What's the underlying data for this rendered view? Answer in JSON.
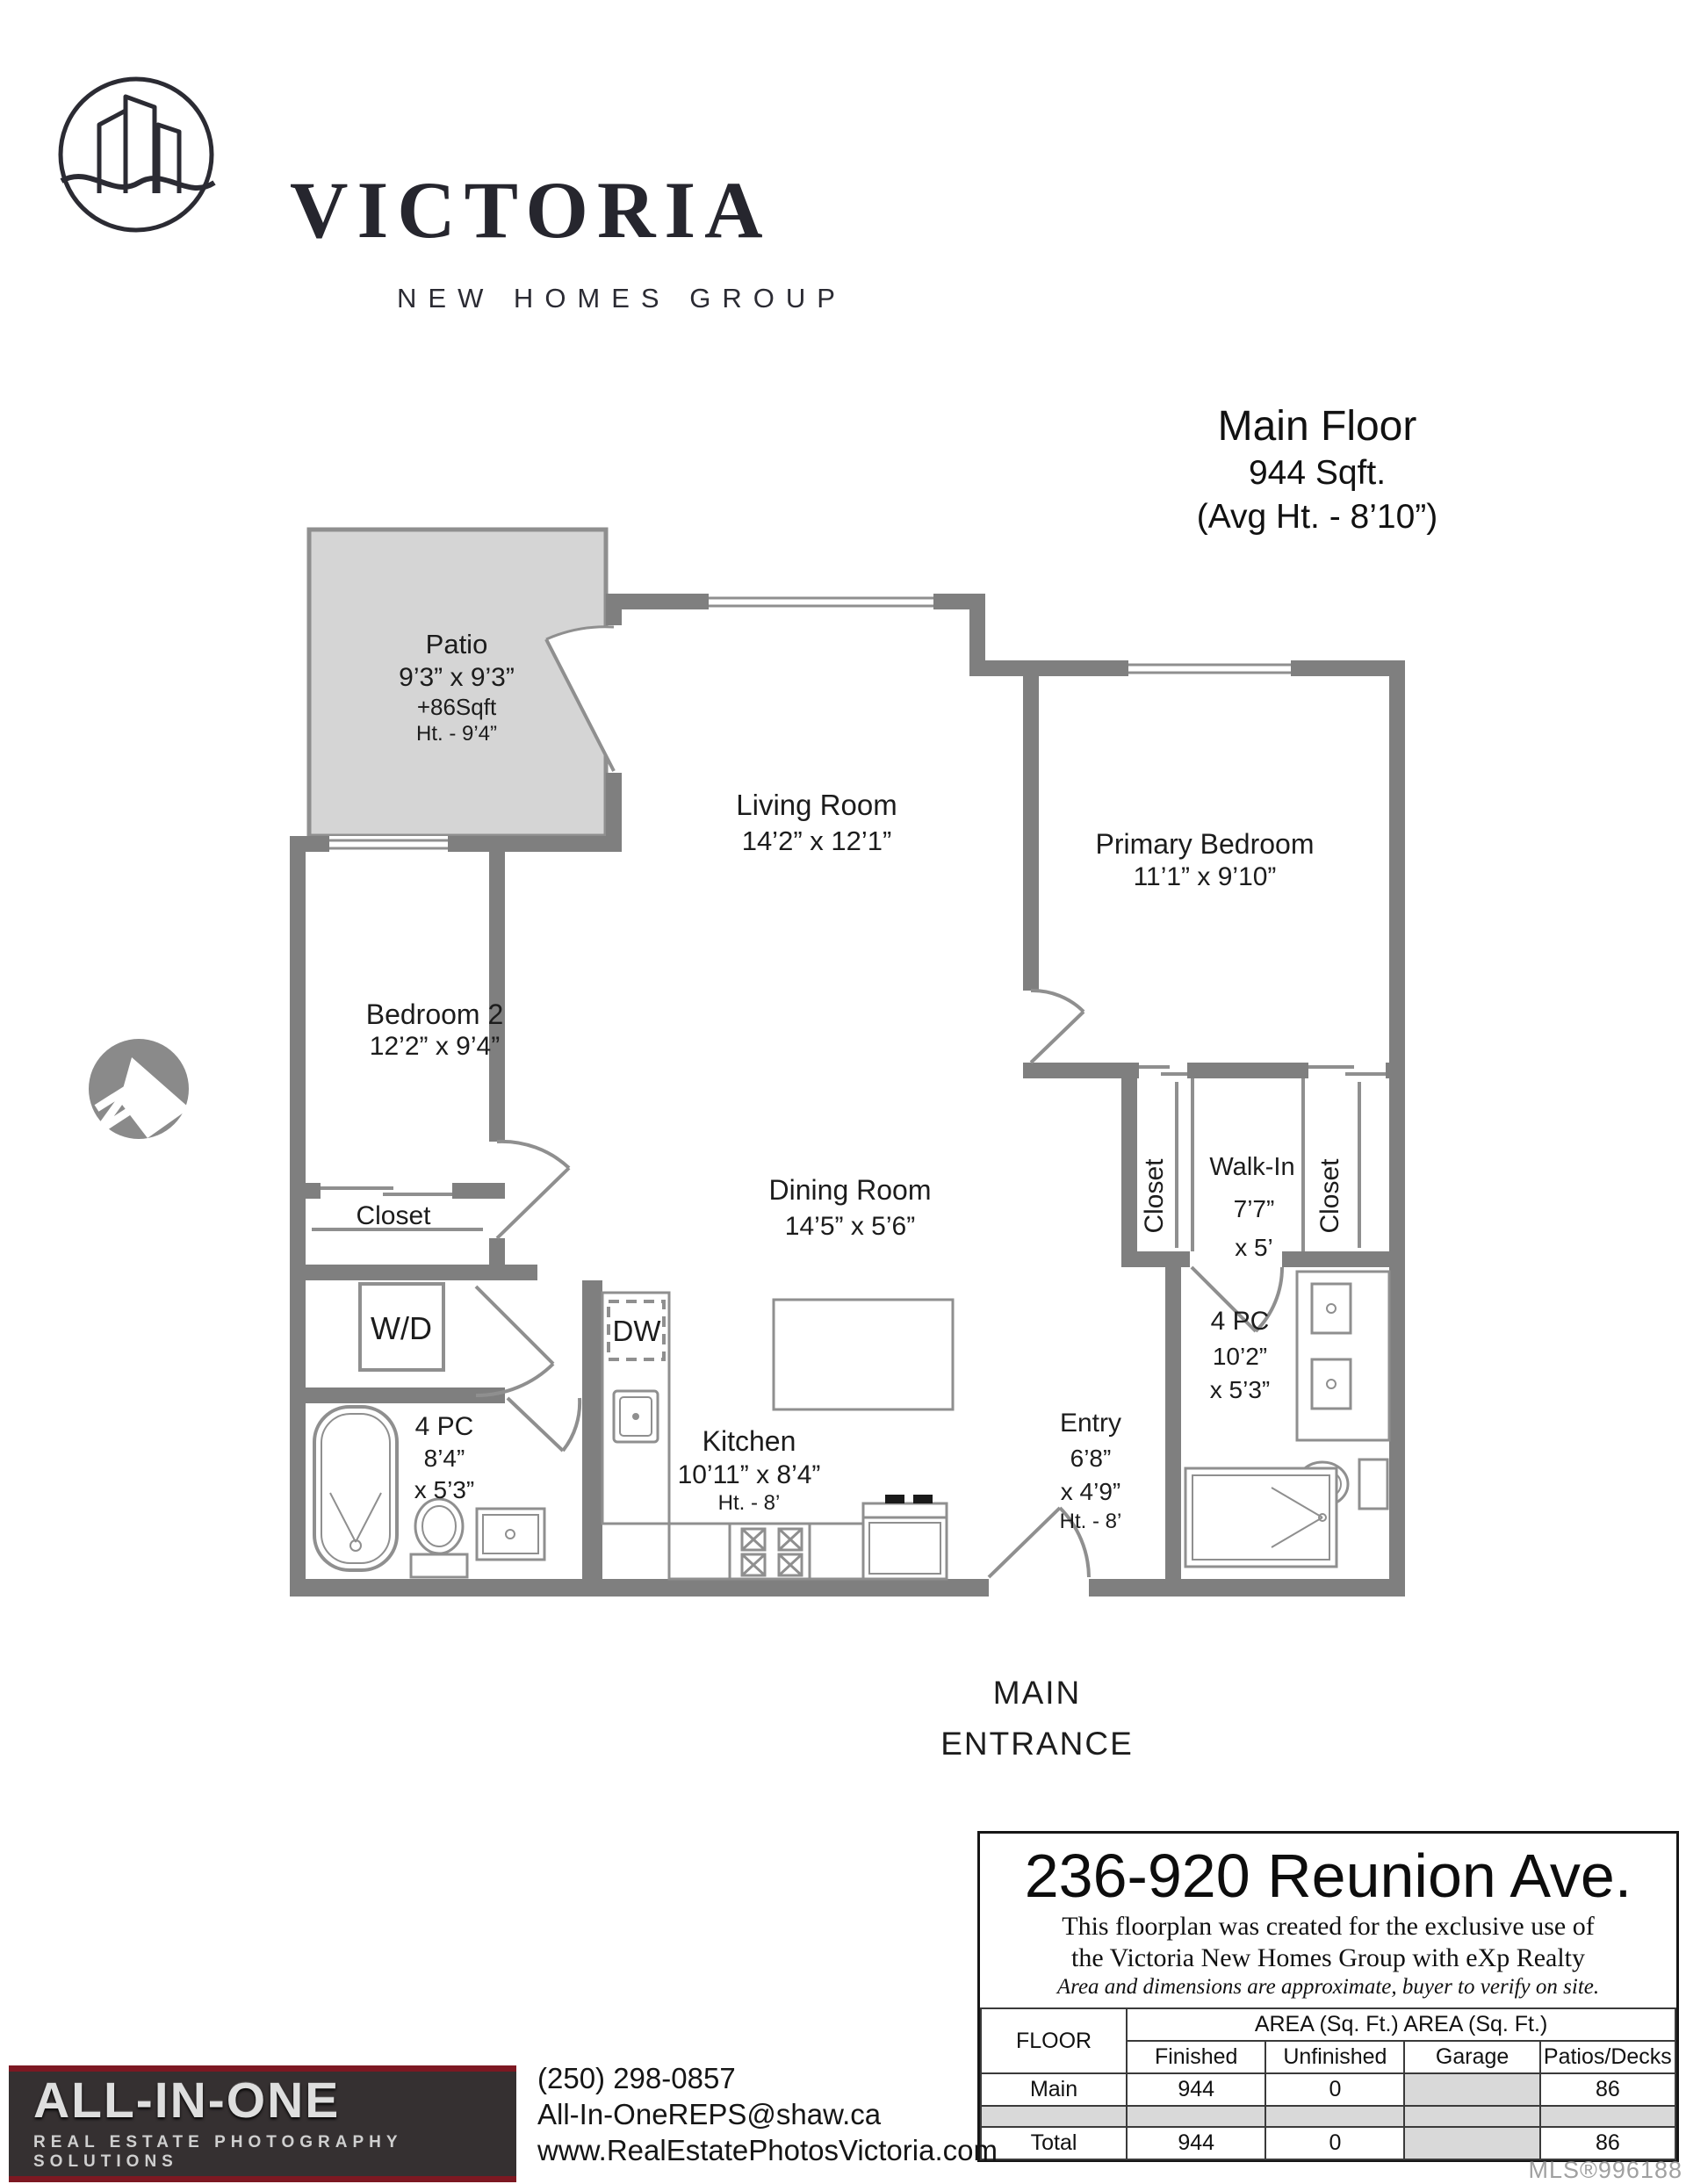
{
  "branding": {
    "logo_title": "VICTORIA",
    "logo_subtitle": "NEW HOMES GROUP"
  },
  "floor_header": {
    "title": "Main Floor",
    "area": "944 Sqft.",
    "avg_height": "(Avg Ht. - 8’10”)"
  },
  "rooms": {
    "patio": {
      "name": "Patio",
      "dims": "9’3” x 9’3”",
      "area": "+86Sqft",
      "height": "Ht. - 9’4”"
    },
    "living": {
      "name": "Living Room",
      "dims": "14’2” x 12’1”"
    },
    "primary": {
      "name": "Primary Bedroom",
      "dims": "11’1” x 9’10”"
    },
    "bedroom2": {
      "name": "Bedroom 2",
      "dims": "12’2” x 9’4”"
    },
    "dining": {
      "name": "Dining Room",
      "dims": "14’5” x 5’6”"
    },
    "walkin": {
      "name": "Walk-In",
      "dim1": "7’7”",
      "dim2": "x 5’"
    },
    "closet_left": {
      "name": "Closet"
    },
    "closet_right": {
      "name": "Closet"
    },
    "closet_bed2": {
      "name": "Closet"
    },
    "wd": {
      "label": "W/D"
    },
    "dw": {
      "label": "DW"
    },
    "bath_left": {
      "name": "4 PC",
      "dim1": "8’4”",
      "dim2": "x 5’3”"
    },
    "bath_right": {
      "name": "4 PC",
      "dim1": "10’2”",
      "dim2": "x 5’3”"
    },
    "kitchen": {
      "name": "Kitchen",
      "dims": "10’11” x 8’4”",
      "height": "Ht. - 8’"
    },
    "entry": {
      "name": "Entry",
      "dim1": "6’8”",
      "dim2": "x 4’9”",
      "height": "Ht. - 8’"
    }
  },
  "main_entrance": {
    "line1": "MAIN",
    "line2": "ENTRANCE"
  },
  "info_box": {
    "address": "236-920 Reunion Ave.",
    "disclaimer1": "This floorplan was created for the exclusive use of",
    "disclaimer2": "the Victoria New Homes Group with eXp Realty",
    "disclaimer3": "Area and dimensions are approximate, buyer to verify on site.",
    "table": {
      "floor_header": "FLOOR",
      "area_header_1": "AREA (Sq. Ft.)",
      "area_header_2": "AREA (Sq. Ft.)",
      "columns": [
        "Finished",
        "Unfinished",
        "Garage",
        "Patios/Decks"
      ],
      "rows": [
        {
          "floor": "Main",
          "finished": "944",
          "unfinished": "0",
          "garage": "",
          "patios": "86"
        },
        {
          "floor": "Total",
          "finished": "944",
          "unfinished": "0",
          "garage": "",
          "patios": "86"
        }
      ]
    },
    "mls": "MLS®996188"
  },
  "footer": {
    "company": "ALL-IN-ONE",
    "tagline": "REAL ESTATE PHOTOGRAPHY SOLUTIONS",
    "phone": "(250) 298-0857",
    "email": "All-In-OneREPS@shaw.ca",
    "website": "www.RealEstatePhotosVictoria.com"
  },
  "colors": {
    "wall": "#7f7f7f",
    "patio_fill": "#d5d5d5",
    "accent_red": "#7d1822"
  }
}
